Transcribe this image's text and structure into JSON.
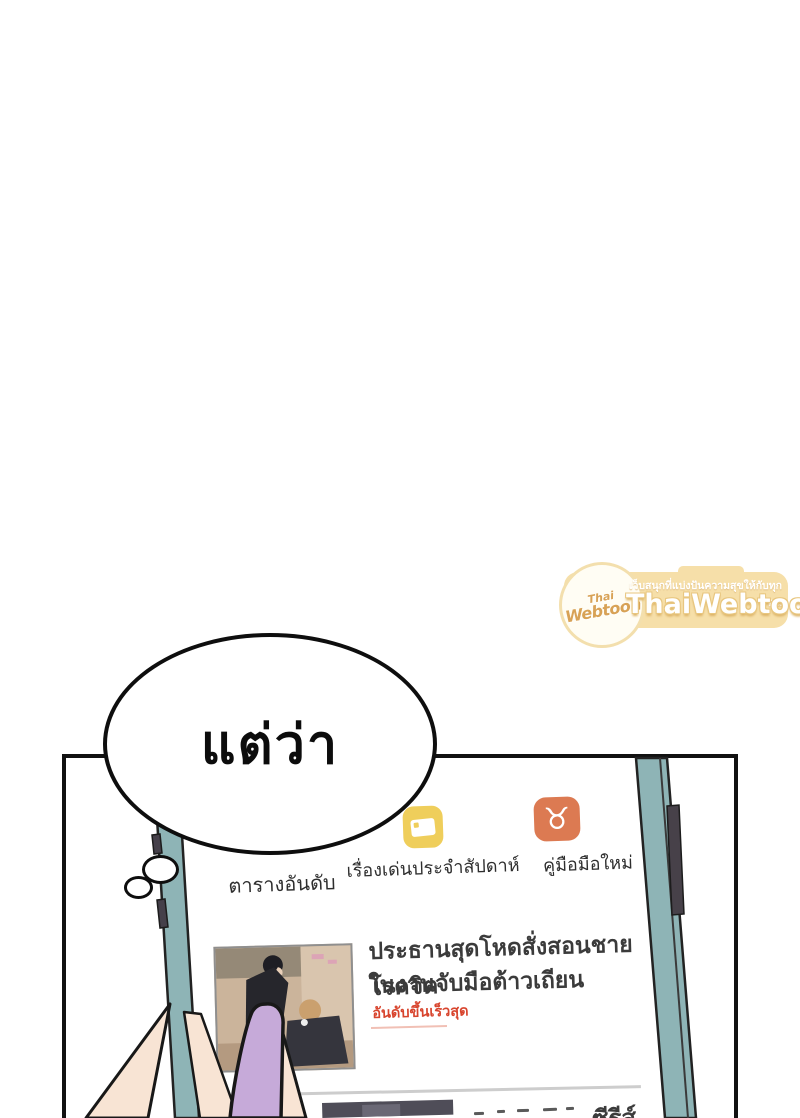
{
  "watermark": {
    "logo_top": "Thai",
    "logo_bottom": "Webtoon",
    "tagline": "เว็บสนุกที่แบ่งปันความสุขให้กับทุกคน",
    "brand": "ThaiWebtoon",
    "badge_bg": "#f6dfa9",
    "accent": "#d8a256"
  },
  "bubble": {
    "text": "แต่ว่า"
  },
  "screen": {
    "tabs": [
      {
        "label": "ตารางอันดับ"
      },
      {
        "label": "เรื่องเด่นประจำสัปดาห์",
        "icon": "featured-card-icon",
        "icon_bg": "#efce5b"
      },
      {
        "label": "คู่มือมือใหม่",
        "icon": "bull-mascot-icon",
        "icon_bg": "#dc7a52",
        "icon_glyph": "♉"
      }
    ],
    "cards": [
      {
        "title_line1": "ประธานสุดโหดสั่งสอนชายโรคจิต",
        "title_line2": "ในงานจับมือต้าวเถียน",
        "tag": "อันดับขึ้นเร็วสุด",
        "tag_color": "#d8452e"
      },
      {
        "visible_fragment": "ซีรีส์"
      }
    ]
  },
  "colors": {
    "phone_edge": "#8eb4b6",
    "thumb_sleeve": "#c6aad9",
    "hand": "#f8e4d4",
    "panel_line": "#111111"
  }
}
